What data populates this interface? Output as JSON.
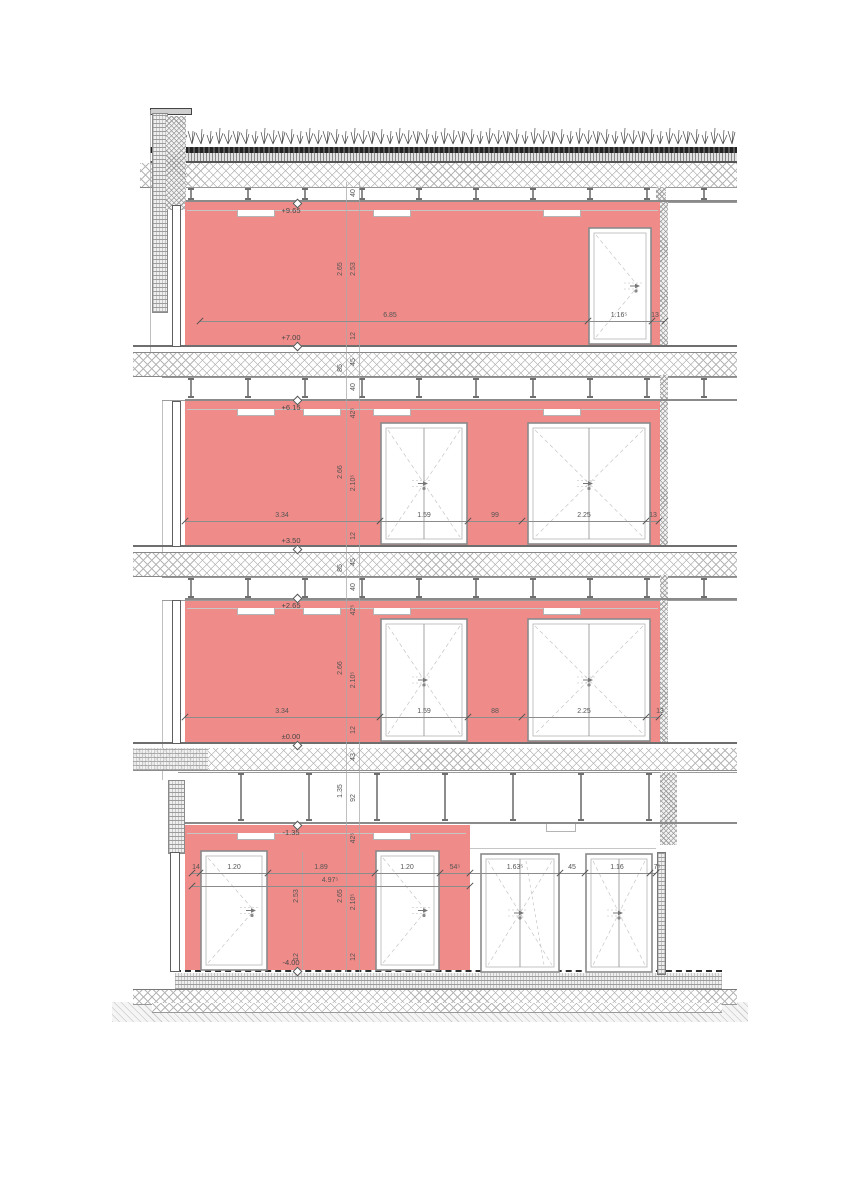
{
  "drawing": {
    "kind_label": "building-section",
    "colors": {
      "wall_fill": "#ef8b88",
      "paper": "#ffffff",
      "dim_text": "#555555",
      "level_text": "#474747"
    }
  },
  "levels": [
    {
      "label": "+9.65",
      "x": 291,
      "y": 211,
      "diamond": "above"
    },
    {
      "label": "+7.00",
      "x": 291,
      "y": 338,
      "diamond": "below"
    },
    {
      "label": "+6.15",
      "x": 291,
      "y": 408,
      "diamond": "above"
    },
    {
      "label": "+3.50",
      "x": 291,
      "y": 541,
      "diamond": "below"
    },
    {
      "label": "+2.65",
      "x": 291,
      "y": 606,
      "diamond": "above"
    },
    {
      "label": "±0.00",
      "x": 291,
      "y": 737,
      "diamond": "below"
    },
    {
      "label": "-1.35",
      "x": 291,
      "y": 833,
      "diamond": "above"
    },
    {
      "label": "-4.00",
      "x": 291,
      "y": 963,
      "diamond": "below"
    }
  ],
  "dims_horizontal": [
    {
      "label": "6.85",
      "x": 390,
      "y": 320
    },
    {
      "label": "1.16⁵",
      "x": 619,
      "y": 320
    },
    {
      "label": "13",
      "x": 655,
      "y": 320
    },
    {
      "label": "3.34",
      "x": 282,
      "y": 520
    },
    {
      "label": "1.59",
      "x": 424,
      "y": 520
    },
    {
      "label": "99",
      "x": 495,
      "y": 520
    },
    {
      "label": "2.25",
      "x": 584,
      "y": 520
    },
    {
      "label": "13",
      "x": 653,
      "y": 520
    },
    {
      "label": "3.34",
      "x": 282,
      "y": 716
    },
    {
      "label": "1.59",
      "x": 424,
      "y": 716
    },
    {
      "label": "88",
      "x": 495,
      "y": 716
    },
    {
      "label": "2.25",
      "x": 584,
      "y": 716
    },
    {
      "label": "13",
      "x": 660,
      "y": 716
    },
    {
      "label": "14",
      "x": 196,
      "y": 872
    },
    {
      "label": "1.20",
      "x": 234,
      "y": 872
    },
    {
      "label": "1.89",
      "x": 321,
      "y": 872
    },
    {
      "label": "1.20",
      "x": 407,
      "y": 872
    },
    {
      "label": "54⁵",
      "x": 455,
      "y": 872
    },
    {
      "label": "1.63⁵",
      "x": 515,
      "y": 872
    },
    {
      "label": "45",
      "x": 572,
      "y": 872
    },
    {
      "label": "1.16",
      "x": 617,
      "y": 872
    },
    {
      "label": "7⁵",
      "x": 657,
      "y": 872
    },
    {
      "label": "4.97⁵",
      "x": 330,
      "y": 885
    }
  ],
  "dims_vertical": [
    {
      "label": "40",
      "x": 354,
      "y": 193
    },
    {
      "label": "2.65",
      "x": 341,
      "y": 269
    },
    {
      "label": "2.53",
      "x": 354,
      "y": 269
    },
    {
      "label": "12",
      "x": 354,
      "y": 336
    },
    {
      "label": "45",
      "x": 354,
      "y": 362
    },
    {
      "label": "85",
      "x": 341,
      "y": 368
    },
    {
      "label": "40",
      "x": 354,
      "y": 387
    },
    {
      "label": "42⁵",
      "x": 354,
      "y": 413
    },
    {
      "label": "2.66",
      "x": 341,
      "y": 472
    },
    {
      "label": "2.10⁵",
      "x": 354,
      "y": 483
    },
    {
      "label": "12",
      "x": 354,
      "y": 536
    },
    {
      "label": "45",
      "x": 354,
      "y": 562
    },
    {
      "label": "85",
      "x": 341,
      "y": 568
    },
    {
      "label": "40",
      "x": 354,
      "y": 587
    },
    {
      "label": "42⁵",
      "x": 354,
      "y": 610
    },
    {
      "label": "2.66",
      "x": 341,
      "y": 668
    },
    {
      "label": "2.10⁵",
      "x": 354,
      "y": 680
    },
    {
      "label": "12",
      "x": 354,
      "y": 730
    },
    {
      "label": "43",
      "x": 354,
      "y": 757
    },
    {
      "label": "1.35",
      "x": 341,
      "y": 791
    },
    {
      "label": "92",
      "x": 354,
      "y": 798
    },
    {
      "label": "42⁵",
      "x": 354,
      "y": 838
    },
    {
      "label": "2.53",
      "x": 297,
      "y": 896
    },
    {
      "label": "2.65",
      "x": 341,
      "y": 896
    },
    {
      "label": "2.10⁵",
      "x": 354,
      "y": 902
    },
    {
      "label": "12",
      "x": 297,
      "y": 957
    },
    {
      "label": "12",
      "x": 354,
      "y": 957
    }
  ]
}
